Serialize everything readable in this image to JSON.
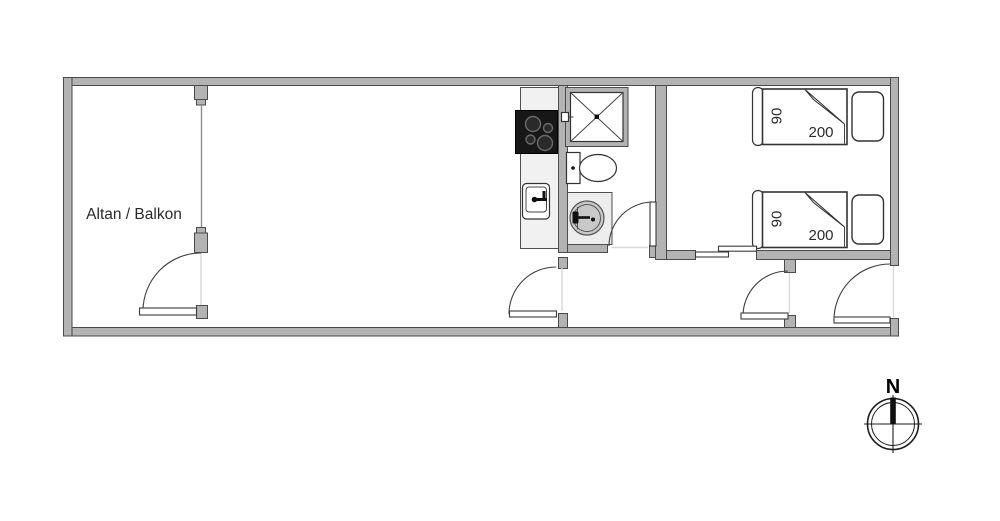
{
  "labels": {
    "balcony": "Altan / Balkon",
    "compass_north": "N"
  },
  "floorplan": {
    "rooms": [
      "balcony",
      "living-room-kitchen",
      "bathroom",
      "bedroom",
      "hallway"
    ],
    "bedroom": {
      "beds": [
        {
          "width_label": "90",
          "length_label": "200"
        },
        {
          "width_label": "90",
          "length_label": "200"
        }
      ]
    },
    "fixtures": {
      "kitchen": [
        "stove",
        "sink",
        "counter"
      ],
      "bathroom": [
        "shower",
        "toilet",
        "washbasin"
      ]
    },
    "doors": [
      "balcony-door",
      "living-room-door",
      "bathroom-door",
      "bedroom-sliding-door",
      "hall-door",
      "entry-door"
    ]
  },
  "colors": {
    "page_bg": "#ffffff",
    "wall_fill": "#b3b3b3",
    "wall_stroke": "#4a4a4a",
    "door_arc": "#3f3f3f",
    "fixture_stroke": "#333333",
    "counter_fill": "#f1f1f1",
    "panel_fill": "#ededed",
    "stove_fill": "#171717",
    "basin_fill": "#c8c8c8",
    "ghost": "#d9d9d9",
    "glass": "#8c8c8c",
    "text_color": "#2a2a2a"
  }
}
